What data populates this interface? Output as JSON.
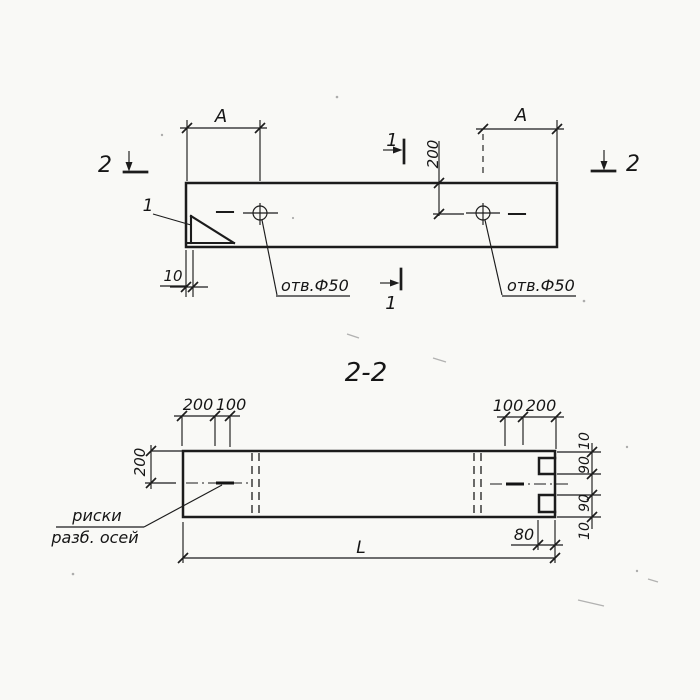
{
  "colors": {
    "ink": "#1c1c1c",
    "paper": "#f9f9f6"
  },
  "plan": {
    "section2_left": "2",
    "section2_right": "2",
    "section1_top": "1",
    "section1_bottom": "1",
    "detail_callout": "1",
    "dim_a_left": "A",
    "dim_a_right": "A",
    "dim_200": "200",
    "dim_10": "10",
    "hole_label_left": "отв.Ф50",
    "hole_label_right": "отв.Ф50"
  },
  "section": {
    "title": "2-2",
    "dim_top_left_200": "200",
    "dim_top_left_100": "100",
    "dim_top_right_100": "100",
    "dim_top_right_200": "200",
    "dim_height_200": "200",
    "dim_right_10_top": "10",
    "dim_right_90_top": "90",
    "dim_right_90_bottom": "90",
    "dim_right_10_bottom": "10",
    "dim_80": "80",
    "dim_length": "L",
    "axes_note_line1": "риски",
    "axes_note_line2": "разб. осей"
  }
}
